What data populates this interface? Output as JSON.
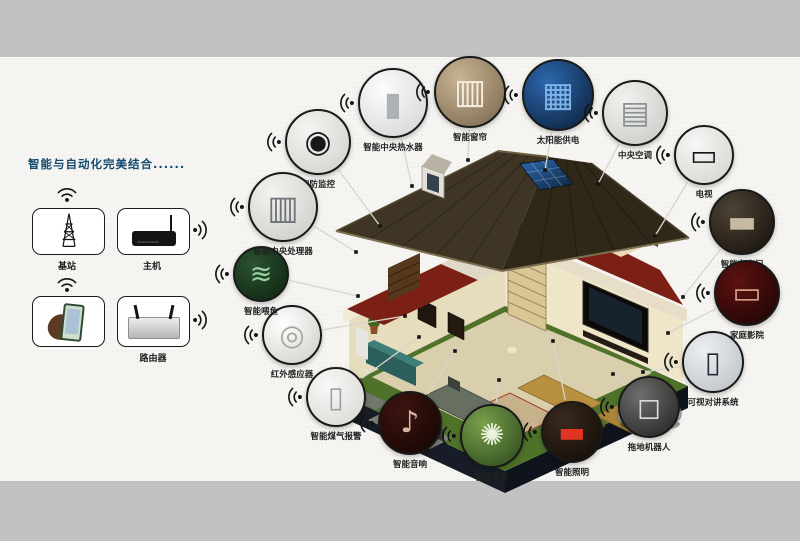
{
  "colors": {
    "outer_background": "#c2c2c2",
    "panel_background": "#f6f5f2",
    "title_color": "#134a70",
    "connector_line": "#d7d5cf",
    "wifi_icon": "#141414"
  },
  "title": {
    "text": "智能与自动化完美结合......"
  },
  "network": {
    "items": [
      {
        "id": "base-station",
        "label": "基站",
        "icon": "radio-tower-icon",
        "wifi": "up"
      },
      {
        "id": "host",
        "label": "主机",
        "icon": "host-box-icon",
        "wifi": "right"
      },
      {
        "id": "phone",
        "label": "",
        "icon": "hand-phone-icon",
        "wifi": "up"
      },
      {
        "id": "router",
        "label": "路由器",
        "icon": "router-icon",
        "wifi": "right"
      }
    ]
  },
  "house": {
    "description": "isometric cutaway smart home with solar roof, two floors, lawn and car"
  },
  "devices": [
    {
      "id": "security-camera",
      "label": "安防监控",
      "cx": 318,
      "cy": 142,
      "r": 33,
      "anchor": [
        380,
        226
      ],
      "glyph": "◉",
      "glyph_color": "#17181c",
      "bg1": "#f4f4f2",
      "bg2": "#cfcfcb"
    },
    {
      "id": "water-heater",
      "label": "智能中央热水器",
      "cx": 393,
      "cy": 103,
      "r": 35,
      "anchor": [
        412,
        186
      ],
      "glyph": "▮",
      "glyph_color": "#aab2b8",
      "bg1": "#fdfdfd",
      "bg2": "#cfd2d4"
    },
    {
      "id": "curtain",
      "label": "智能窗帘",
      "cx": 470,
      "cy": 92,
      "r": 36,
      "anchor": [
        468,
        160
      ],
      "glyph": "▥",
      "glyph_color": "#f3eee2",
      "bg1": "#c9b493",
      "bg2": "#77664e"
    },
    {
      "id": "solar-power",
      "label": "太阳能供电",
      "cx": 558,
      "cy": 95,
      "r": 36,
      "anchor": [
        545,
        170
      ],
      "glyph": "▦",
      "glyph_color": "#7fb3e8",
      "bg1": "#2c68ae",
      "bg2": "#0a1c33"
    },
    {
      "id": "central-ac",
      "label": "中央空调",
      "cx": 635,
      "cy": 113,
      "r": 33,
      "anchor": [
        598,
        184
      ],
      "glyph": "▤",
      "glyph_color": "#8d9297",
      "bg1": "#f2f2f0",
      "bg2": "#c6c6c2"
    },
    {
      "id": "tv",
      "label": "电视",
      "cx": 704,
      "cy": 155,
      "r": 30,
      "anchor": [
        655,
        236
      ],
      "glyph": "▭",
      "glyph_color": "#141414",
      "bg1": "#f6f6f4",
      "bg2": "#d2d2cf"
    },
    {
      "id": "garage-door",
      "label": "智能车库门",
      "cx": 742,
      "cy": 222,
      "r": 33,
      "anchor": [
        683,
        297
      ],
      "glyph": "▬",
      "glyph_color": "#c8b9a2",
      "bg1": "#4d4336",
      "bg2": "#150f0a"
    },
    {
      "id": "home-theater",
      "label": "家庭影院",
      "cx": 747,
      "cy": 293,
      "r": 33,
      "anchor": [
        668,
        333
      ],
      "glyph": "▭",
      "glyph_color": "#d09c8a",
      "bg1": "#5c1210",
      "bg2": "#190303"
    },
    {
      "id": "video-intercom",
      "label": "可视对讲系统",
      "cx": 713,
      "cy": 362,
      "r": 31,
      "anchor": [
        643,
        372
      ],
      "glyph": "▯",
      "glyph_color": "#232b37",
      "bg1": "#eceff1",
      "bg2": "#b9bec4"
    },
    {
      "id": "mopping-robot",
      "label": "拖地机器人",
      "cx": 649,
      "cy": 407,
      "r": 31,
      "anchor": [
        613,
        374
      ],
      "glyph": "◻",
      "glyph_color": "#dadbdc",
      "bg1": "#6e6e6c",
      "bg2": "#1f1f1e"
    },
    {
      "id": "smart-lighting",
      "label": "智能照明",
      "cx": 572,
      "cy": 432,
      "r": 31,
      "anchor": [
        553,
        341
      ],
      "glyph": "▬",
      "glyph_color": "#e23422",
      "bg1": "#382a1e",
      "bg2": "#100a06"
    },
    {
      "id": "sprinkler",
      "label": "智能浇花",
      "cx": 492,
      "cy": 436,
      "r": 32,
      "anchor": [
        499,
        380
      ],
      "glyph": "✺",
      "glyph_color": "#e9f2dc",
      "bg1": "#7aa04c",
      "bg2": "#29451a"
    },
    {
      "id": "smart-audio",
      "label": "智能音响",
      "cx": 410,
      "cy": 423,
      "r": 32,
      "anchor": [
        455,
        351
      ],
      "glyph": "♪",
      "glyph_color": "#d8b4a2",
      "bg1": "#3c1410",
      "bg2": "#120503"
    },
    {
      "id": "gas-alarm",
      "label": "智能煤气报警",
      "cx": 336,
      "cy": 397,
      "r": 30,
      "anchor": [
        419,
        337
      ],
      "glyph": "▯",
      "glyph_color": "#98a1a8",
      "bg1": "#f8f8f6",
      "bg2": "#d6d6d2"
    },
    {
      "id": "infrared-sensor",
      "label": "红外感应器",
      "cx": 292,
      "cy": 335,
      "r": 30,
      "anchor": [
        405,
        316
      ],
      "glyph": "◎",
      "glyph_color": "#a5a59e",
      "bg1": "#ffffff",
      "bg2": "#ccccc6"
    },
    {
      "id": "fish-feeder",
      "label": "智能喂鱼",
      "cx": 261,
      "cy": 274,
      "r": 28,
      "anchor": [
        358,
        296
      ],
      "glyph": "≋",
      "glyph_color": "#9cd2a6",
      "bg1": "#2c5230",
      "bg2": "#0d2210"
    },
    {
      "id": "central-processor",
      "label": "智能中央处理器",
      "cx": 283,
      "cy": 207,
      "r": 35,
      "anchor": [
        356,
        252
      ],
      "glyph": "▥",
      "glyph_color": "#6e7478",
      "bg1": "#f3f3f0",
      "bg2": "#c9c9c4"
    }
  ]
}
